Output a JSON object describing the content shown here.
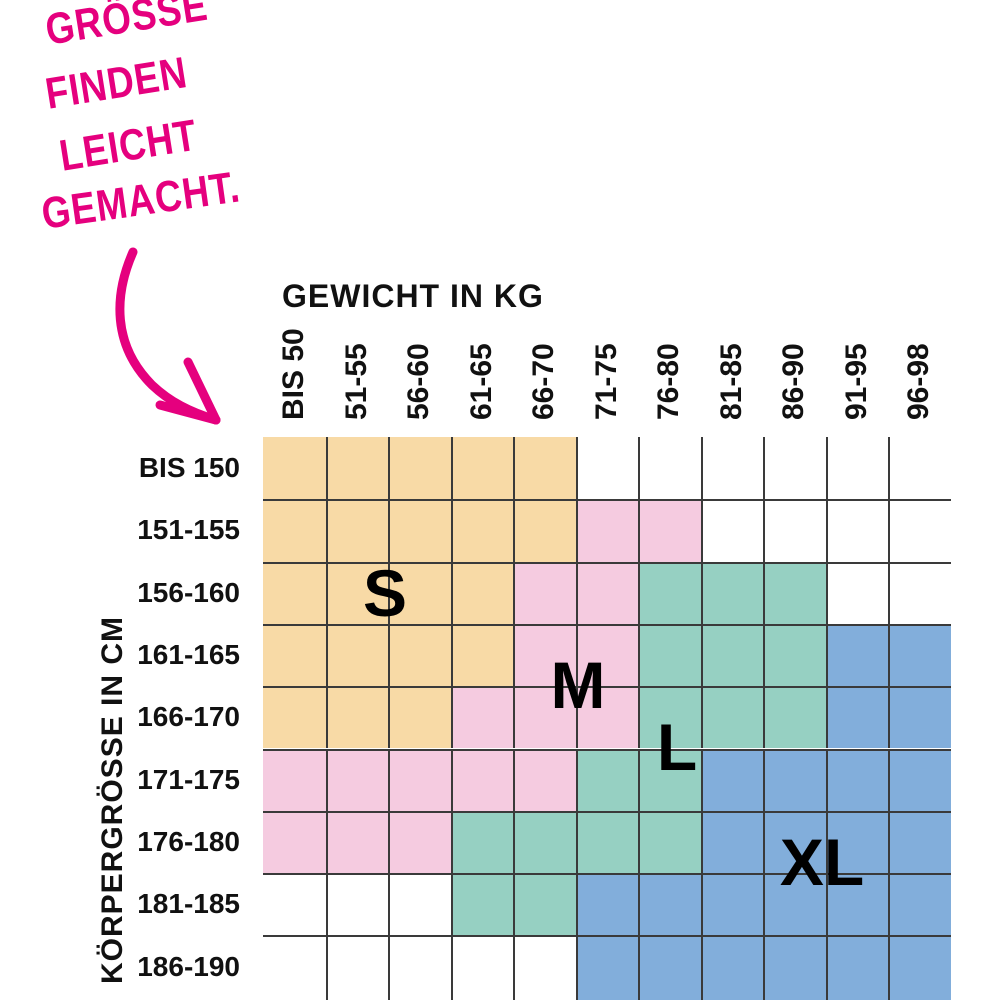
{
  "headline": {
    "lines": [
      "GRÖSSE",
      "FINDEN",
      "LEICHT",
      "GEMACHT."
    ],
    "color": "#E5007E"
  },
  "chart_data": {
    "type": "heatmap",
    "title": "GRÖSSE FINDEN LEICHT GEMACHT.",
    "xlabel": "GEWICHT IN KG",
    "ylabel": "KÖRPERGRÖSSE IN CM",
    "columns": [
      "BIS 50",
      "51-55",
      "56-60",
      "61-65",
      "66-70",
      "71-75",
      "76-80",
      "81-85",
      "86-90",
      "91-95",
      "96-98"
    ],
    "rows": [
      "BIS 150",
      "151-155",
      "156-160",
      "161-165",
      "166-170",
      "171-175",
      "176-180",
      "181-185",
      "186-190"
    ],
    "matrix": [
      [
        "S",
        "S",
        "S",
        "S",
        "S",
        "",
        "",
        "",
        "",
        "",
        ""
      ],
      [
        "S",
        "S",
        "S",
        "S",
        "S",
        "M",
        "M",
        "",
        "",
        "",
        ""
      ],
      [
        "S",
        "S",
        "S",
        "S",
        "M",
        "M",
        "L",
        "L",
        "L",
        "",
        ""
      ],
      [
        "S",
        "S",
        "S",
        "S",
        "M",
        "M",
        "L",
        "L",
        "L",
        "XL",
        "XL"
      ],
      [
        "S",
        "S",
        "S",
        "M",
        "M",
        "M",
        "L",
        "L",
        "L",
        "XL",
        "XL"
      ],
      [
        "M",
        "M",
        "M",
        "M",
        "M",
        "L",
        "L",
        "XL",
        "XL",
        "XL",
        "XL"
      ],
      [
        "M",
        "M",
        "M",
        "L",
        "L",
        "L",
        "L",
        "XL",
        "XL",
        "XL",
        "XL"
      ],
      [
        "",
        "",
        "",
        "L",
        "L",
        "XL",
        "XL",
        "XL",
        "XL",
        "XL",
        "XL"
      ],
      [
        "",
        "",
        "",
        "",
        "",
        "XL",
        "XL",
        "XL",
        "XL",
        "XL",
        "XL"
      ]
    ],
    "size_labels": [
      {
        "code": "S",
        "color": "#F8DAA6"
      },
      {
        "code": "M",
        "color": "#F5CBE0"
      },
      {
        "code": "L",
        "color": "#96D0C2"
      },
      {
        "code": "XL",
        "color": "#82AEDB"
      }
    ],
    "grid": true,
    "grid_line_color": "#3a3a3a",
    "legend_position": "in-chart"
  }
}
